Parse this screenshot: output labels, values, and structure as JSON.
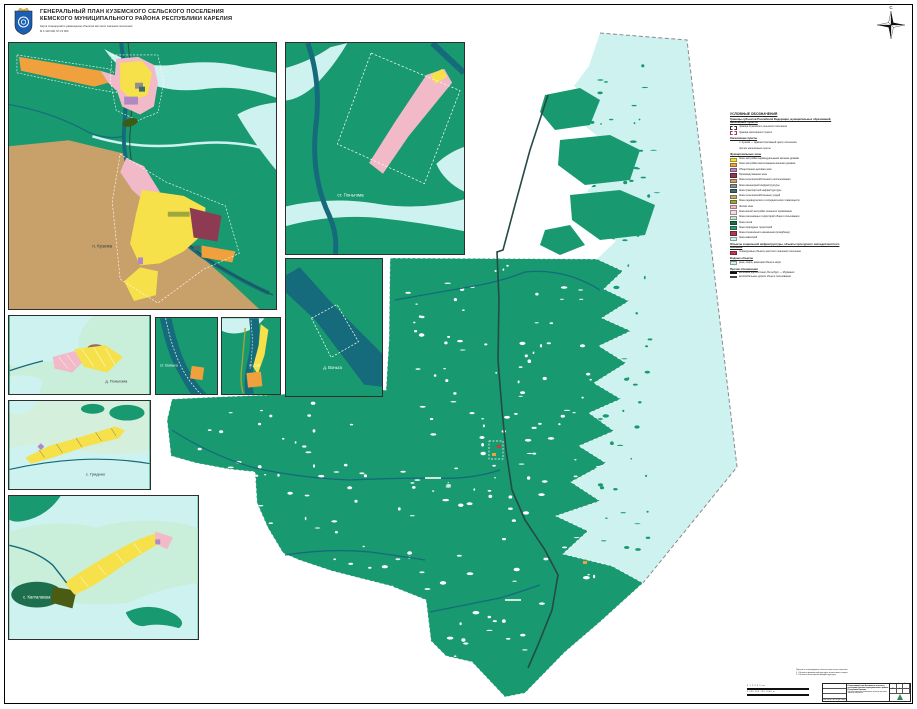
{
  "header": {
    "title_line1": "ГЕНЕРАЛЬНЫЙ ПЛАН КУЗЕМСКОГО СЕЛЬСКОГО ПОСЕЛЕНИЯ",
    "title_line2": "КЕМСКОГО МУНИЦИПАЛЬНОГО РАЙОНА РЕСПУБЛИКИ КАРЕЛИЯ",
    "subtitle_line1": "Карта планируемого размещения объектов местного значения поселения",
    "subtitle_line2": "М 1:100 000, М 1:5 000"
  },
  "compass": {
    "north_label": "С"
  },
  "insets": {
    "kuzema": {
      "label": "п. Кузема"
    },
    "pongoma_st": {
      "label": "ст. Поньгома"
    },
    "vonga": {
      "label": "д. Воньга"
    },
    "pongoma": {
      "label": "д. Поньгома"
    },
    "vonga_st": {
      "label": "ст. Воньга"
    },
    "sig_st": {
      "label": "ст. Сиг"
    },
    "gridino": {
      "label": "с. Гридино"
    },
    "kalgalaksha": {
      "label": "с. Калгалакша"
    }
  },
  "legend": {
    "title": "УСЛОВНЫЕ ОБОЗНАЧЕНИЯ",
    "sections": [
      {
        "title": "Границы субъектов Российской Федерации, муниципальных образований, населённых пунктов",
        "items": [
          {
            "symbol": "box-dashdot",
            "label": "граница Куземского сельского поселения"
          },
          {
            "symbol": "box-dash",
            "label": "граница населённого пункта"
          }
        ]
      },
      {
        "title": "Населённые пункты",
        "items": [
          {
            "symbol": "none",
            "label": "п. Кузема — административный центр поселения"
          },
          {
            "symbol": "none",
            "label": "прочие населённые пункты"
          }
        ]
      },
      {
        "title": "Функциональные зоны",
        "items": [
          {
            "symbol": "#f6e14b",
            "label": "Зона застройки индивидуальными жилыми домами"
          },
          {
            "symbol": "#f0a03c",
            "label": "Зона застройки малоэтажными жилыми домами"
          },
          {
            "symbol": "#b089c4",
            "label": "Общественно-деловая зона"
          },
          {
            "symbol": "#8e3a52",
            "label": "Производственная зона"
          },
          {
            "symbol": "#c8a06a",
            "label": "Зона сельскохозяйственного использования"
          },
          {
            "symbol": "#8f8f8f",
            "label": "Зона инженерной инфраструктуры"
          },
          {
            "symbol": "#3f6a6e",
            "label": "Зона транспортной инфраструктуры"
          },
          {
            "symbol": "#bfae6e",
            "label": "Зона сельскохозяйственных угодий"
          },
          {
            "symbol": "#9ea73e",
            "label": "Зона садоводческих и огороднических товариществ"
          },
          {
            "symbol": "#f2b9c8",
            "label": "Жилая зона"
          },
          {
            "symbol": "#f8d8e2",
            "label": "Зона жилой застройки сезонного проживания"
          },
          {
            "symbol": "#c2e8c8",
            "label": "Зона озеленённых территорий общего пользования"
          },
          {
            "symbol": "#1c6e4d",
            "label": "Зона лесов"
          },
          {
            "symbol": "#2f9e72",
            "label": "Зона природных территорий"
          },
          {
            "symbol": "#b03a50",
            "label": "Зона специального назначения (кладбища)"
          },
          {
            "symbol": "#cdf2ef",
            "label": "Зона акваторий"
          }
        ]
      },
      {
        "title": "Объекты социальной инфраструктуры, объекты культурного наследия местного значения",
        "items": [
          {
            "symbol": "#c0394f",
            "label": "планируемые объекты местного значения поселения"
          }
        ]
      },
      {
        "title": "Водные объекты",
        "items": [
          {
            "symbol": "#cdf2ef",
            "label": "реки, озёра, акватория Белого моря"
          }
        ]
      },
      {
        "title": "Прочие обозначения",
        "items": [
          {
            "symbol": "line-rail",
            "label": "железная дорога Санкт-Петербург — Мурманск"
          },
          {
            "symbol": "line-road",
            "label": "автомобильные дороги общего пользования"
          }
        ]
      }
    ]
  },
  "notes": {
    "line1": "Перечень планируемых объектов местного значения:",
    "line2": "1. Объекты физической культуры и массового спорта",
    "line3": "2. Объекты инженерной инфраструктуры"
  },
  "scalebars": {
    "bar1": "0    1    2    3    4    5 км",
    "bar2": "0   250   500   750   1000 м"
  },
  "titleblock": {
    "project": "Генеральный план Куземского сельского поселения Кемского муниципального района Республики Карелия",
    "sheet_name": "Карта планируемого размещения объектов местного значения поселения",
    "stamp_cols": "Изм. Кол.уч. Лист № док. Подп. Дата",
    "stage_label": "Стадия",
    "stage": "ГП",
    "sheet_label": "Лист",
    "sheet_no": "3",
    "sheets_label": "Листов",
    "sheets_total": "5"
  },
  "colors": {
    "land_green": "#18996f",
    "forest_dark_green": "#1c6e4d",
    "sea_cyan": "#cdf2ef",
    "river_teal": "#156b7c",
    "railway": "#254b47",
    "agriculture_tan": "#c8a06a",
    "residential_yellow": "#f6e14b",
    "lowrise_orange": "#f0a03c",
    "housing_pink": "#f2b9c8",
    "industrial_maroon": "#8e3a52",
    "public_purple": "#b089c4",
    "special_crimson": "#b03a50",
    "light_green_land": "#c9eeda"
  }
}
